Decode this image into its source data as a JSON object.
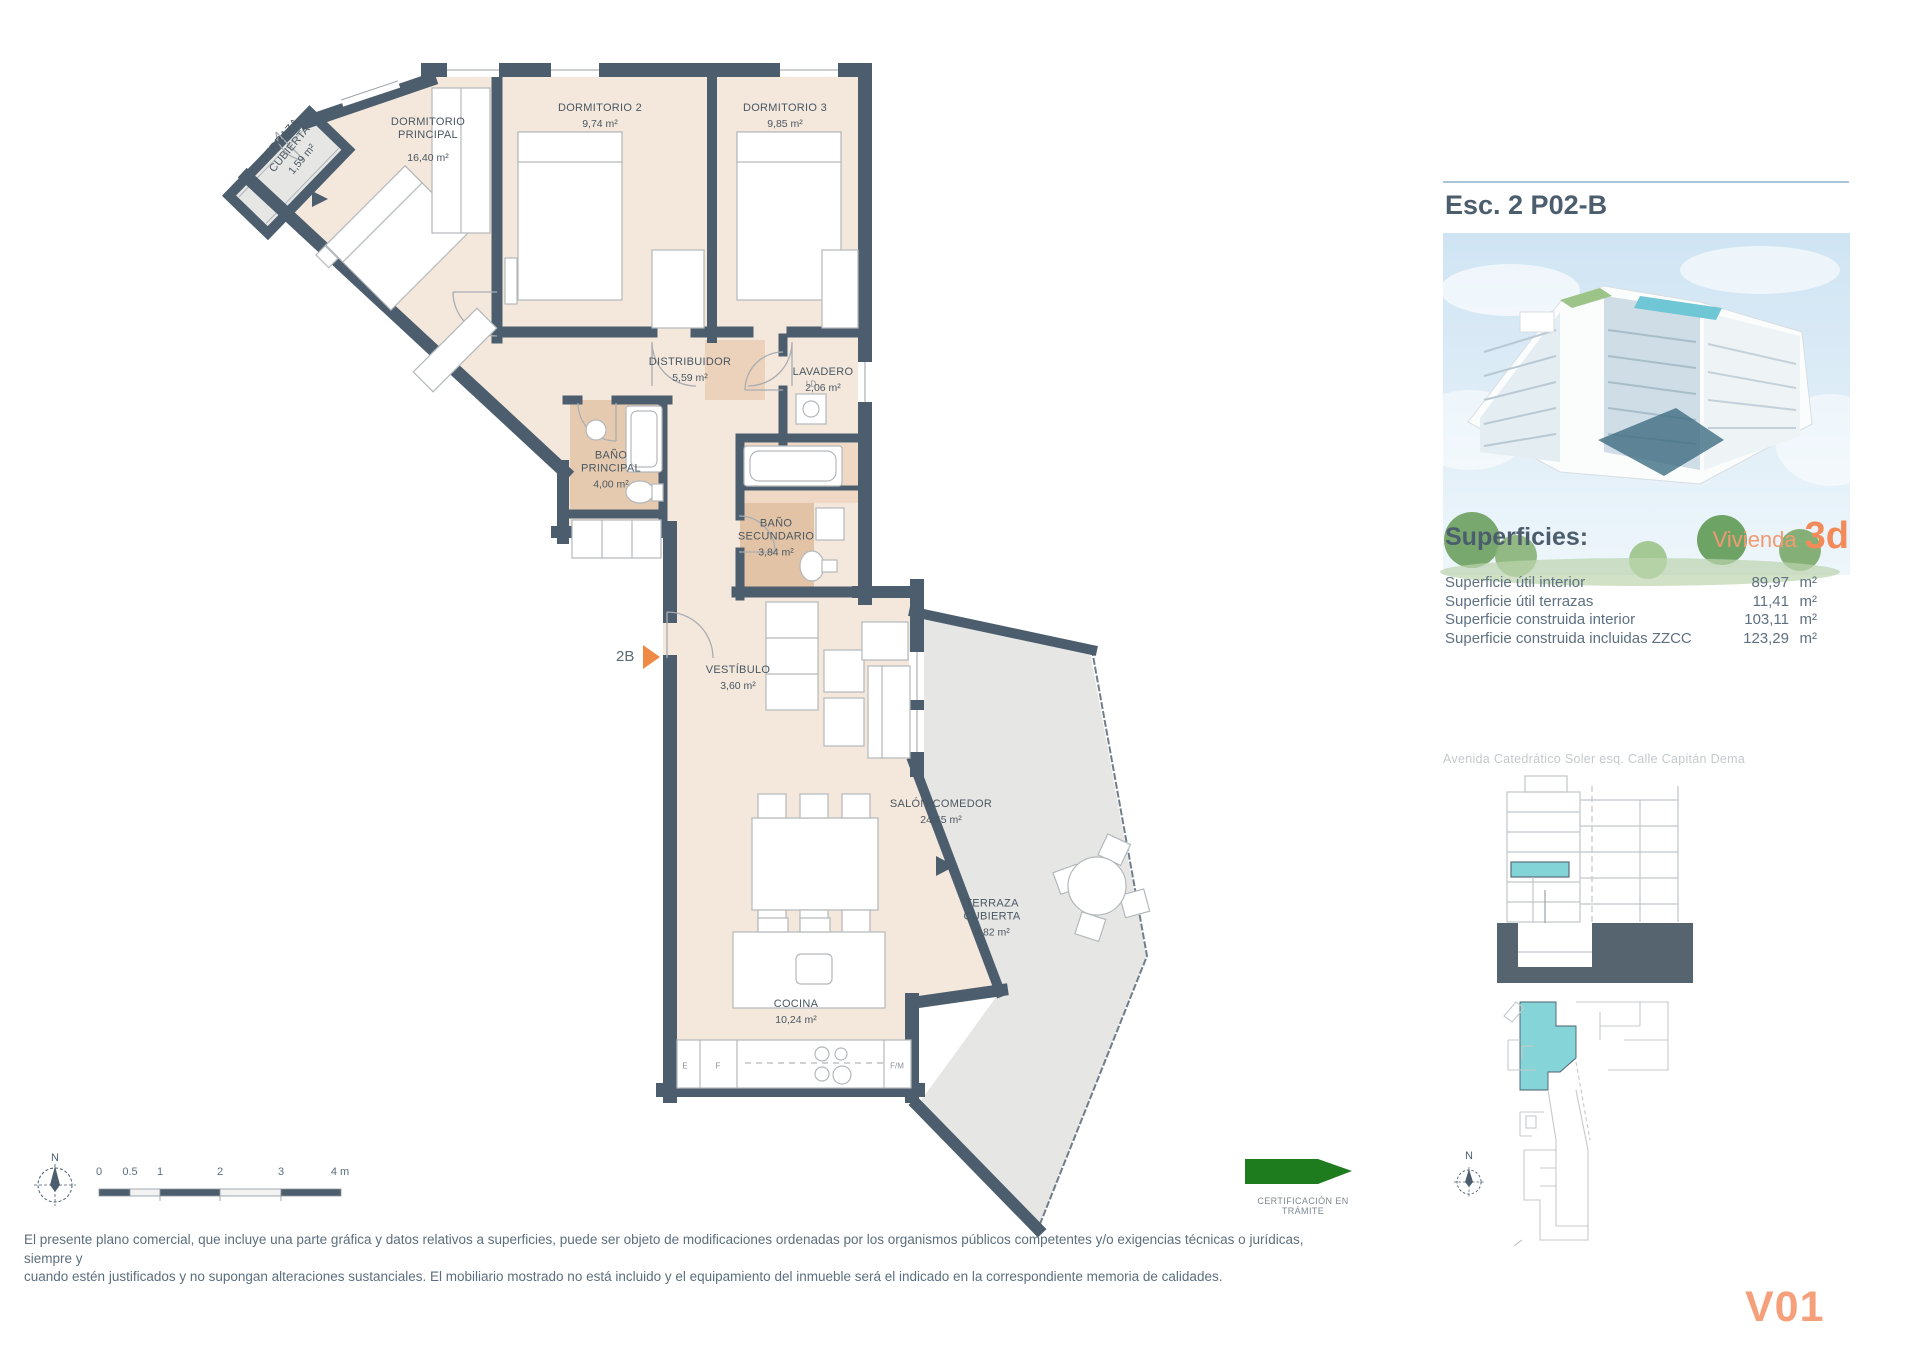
{
  "plan": {
    "rooms": [
      {
        "id": "terraza-cubierta-norte",
        "name": "TERRAZA\nCUBIERTA",
        "area": "1,59 m²",
        "x": 291,
        "y": 150,
        "rotate": -50
      },
      {
        "id": "dormitorio-principal",
        "name": "DORMITORIO\nPRINCIPAL",
        "area": "16,40 m²",
        "x": 428,
        "y": 140,
        "gap": 10
      },
      {
        "id": "dormitorio-2",
        "name": "DORMITORIO 2",
        "area": "9,74 m²",
        "x": 600,
        "y": 116
      },
      {
        "id": "dormitorio-3",
        "name": "DORMITORIO 3",
        "area": "9,85 m²",
        "x": 785,
        "y": 116
      },
      {
        "id": "distribuidor",
        "name": "DISTRIBUIDOR",
        "area": "5,59 m²",
        "x": 690,
        "y": 370
      },
      {
        "id": "lavadero",
        "name": "LAVADERO",
        "area": "2,06 m²",
        "x": 823,
        "y": 380
      },
      {
        "id": "bano-principal",
        "name": "BAÑO\nPRINCIPAL",
        "area": "4,00 m²",
        "x": 611,
        "y": 470
      },
      {
        "id": "bano-secundario",
        "name": "BAÑO\nSECUNDARIO",
        "area": "3,84 m²",
        "x": 776,
        "y": 538
      },
      {
        "id": "vestibulo",
        "name": "VESTÍBULO",
        "area": "3,60 m²",
        "x": 738,
        "y": 678
      },
      {
        "id": "salon-comedor",
        "name": "SALÓN-COMEDOR",
        "area": "24,45 m²",
        "x": 941,
        "y": 812
      },
      {
        "id": "terraza-cubierta-sur",
        "name": "TERRAZA\nCUBIERTA",
        "area": "9,82 m²",
        "x": 992,
        "y": 918
      },
      {
        "id": "cocina",
        "name": "COCINA",
        "area": "10,24 m²",
        "x": 796,
        "y": 1012
      }
    ],
    "entrance_code": "2B",
    "appliances": {
      "left": "E",
      "mid": "F",
      "right": "F/M",
      "laundry": "LD"
    }
  },
  "side_panel": {
    "title": "Esc. 2 P02-B",
    "superficies_heading": "Superficies:",
    "vivienda_label": "Vivienda",
    "vivienda_code": "3d",
    "rows": [
      {
        "label": "Superficie útil interior",
        "value": "89,97",
        "unit": "m²"
      },
      {
        "label": "Superficie útil terrazas",
        "value": "11,41",
        "unit": "m²"
      },
      {
        "label": "Superficie construida interior",
        "value": "103,11",
        "unit": "m²"
      },
      {
        "label": "Superficie construida incluidas ZZCC",
        "value": "123,29",
        "unit": "m²"
      }
    ],
    "address": "Avenida Catedrático Soler esq. Calle Capitán Dema"
  },
  "footer": {
    "legal_line1": "El presente plano comercial, que incluye una parte gráfica y datos relativos a superficies, puede ser objeto de modificaciones ordenadas por los organismos públicos competentes y/o exigencias técnicas o jurídicas, siempre y",
    "legal_line2": "cuando estén justificados y no supongan alteraciones sustanciales. El mobiliario mostrado no está incluido y el equipamiento del inmueble será el indicado en la correspondiente memoria de calidades.",
    "certification": "CERTIFICACIÓN EN TRÁMITE",
    "version": "V01",
    "north": "N",
    "scale_labels": [
      {
        "label": "0",
        "x": 99
      },
      {
        "label": "0.5",
        "x": 130
      },
      {
        "label": "1",
        "x": 160
      },
      {
        "label": "2",
        "x": 220
      },
      {
        "label": "3",
        "x": 281
      },
      {
        "label": "4 m",
        "x": 340
      }
    ]
  },
  "colors": {
    "wall": "#4c5e6d",
    "floor": "#f4e7dc",
    "bath": "#e6caaf",
    "terrace": "#e6e6e5",
    "accent_orange": "#ee8a44",
    "brand_orange": "#f29b73",
    "version_orange": "#f5a07b",
    "cert_green": "#1e7b1e",
    "highlight_teal": "#82d4d7",
    "slate_text": "#4c5e6d"
  }
}
